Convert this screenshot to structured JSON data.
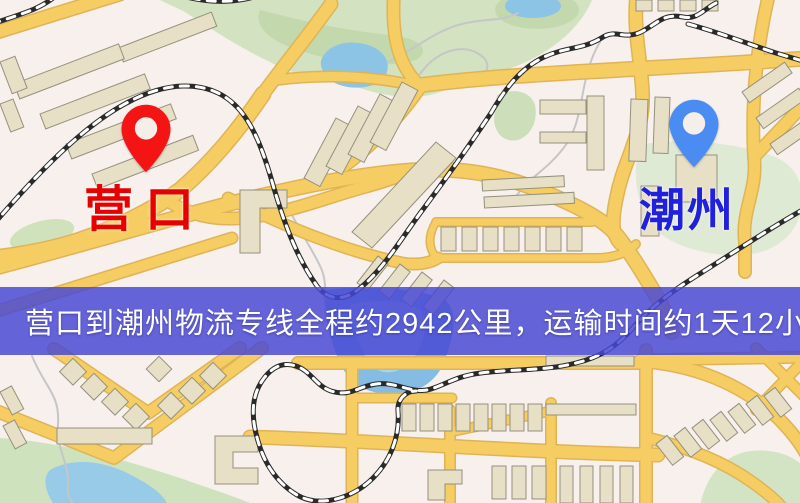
{
  "map": {
    "origin_marker": {
      "label": "营口",
      "pin_color": "#f41414",
      "label_color": "#e60000"
    },
    "destination_marker": {
      "label": "潮州",
      "pin_color": "#4a8cf2",
      "label_color": "#2020dd"
    }
  },
  "banner": {
    "text": "营口到潮州物流专线全程约2942公里，运输时间约1天12小时.",
    "background_color": "#4848d4",
    "text_color": "#ffffff"
  },
  "map_palette": {
    "background": "#f7f0ec",
    "road": "#f5cd62",
    "road_casing": "#dfb457",
    "building": "#e7dfc6",
    "building_outline": "#94917e",
    "park": "#d3e2c0",
    "park_dark": "#c3d9ad",
    "water": "#8cc4e6",
    "railway": "#2a2a2a"
  }
}
